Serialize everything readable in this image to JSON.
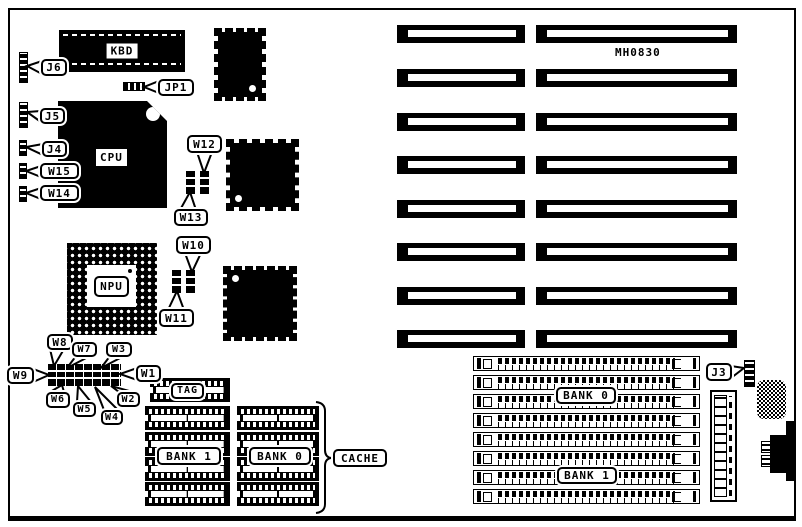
{
  "board": {
    "part_number": "MH0830",
    "ink_color": "#000000",
    "paper_color": "#ffffff"
  },
  "labels": {
    "kbd": "KBD",
    "cpu": "CPU",
    "npu": "NPU",
    "j6": "J6",
    "jp1": "JP1",
    "j5": "J5",
    "j4": "J4",
    "w15": "W15",
    "w14": "W14",
    "w12": "W12",
    "w13": "W13",
    "w10": "W10",
    "w11": "W11",
    "w9": "W9",
    "w8": "W8",
    "w7": "W7",
    "w3": "W3",
    "w1": "W1",
    "w6": "W6",
    "w5": "W5",
    "w2": "W2",
    "w4": "W4",
    "tag": "TAG",
    "cache_bank1": "BANK 1",
    "cache_bank0": "BANK 0",
    "cache": "CACHE",
    "simm_bank0": "BANK 0",
    "simm_bank1": "BANK 1",
    "j3": "J3"
  }
}
